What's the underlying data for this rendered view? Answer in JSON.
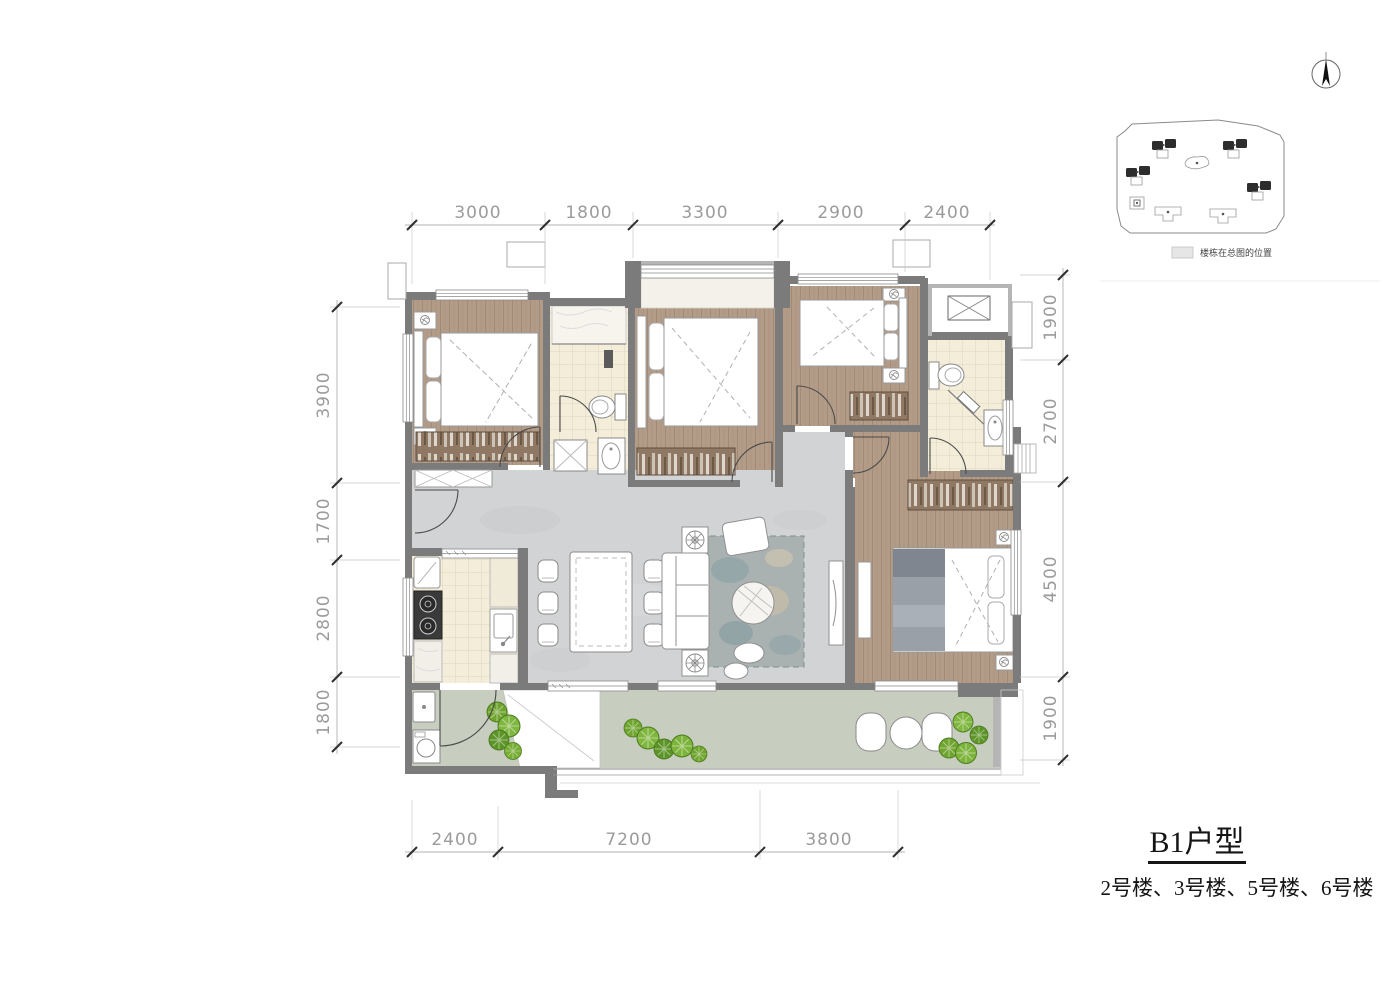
{
  "drawing": {
    "title": "B1户型",
    "subtitle": "2号楼、3号楼、5号楼、6号楼"
  },
  "site_map": {
    "legend_label": "楼栋在总图的位置",
    "highlight_building_count": 4
  },
  "dimensions": {
    "top": [
      "3000",
      "1800",
      "3300",
      "2900",
      "2400"
    ],
    "left": [
      "3900",
      "1700",
      "2800",
      "1800"
    ],
    "right": [
      "1900",
      "2700",
      "4500",
      "1900"
    ],
    "bottom": [
      "2400",
      "7200",
      "3800"
    ]
  },
  "icons": [
    "north-arrow-icon",
    "ac-unit-icon",
    "toilet-icon",
    "shower-icon",
    "sink-icon",
    "stove-icon",
    "fridge-icon",
    "washer-icon",
    "tree-icon",
    "sofa-icon",
    "bed-icon",
    "dining-table-icon"
  ],
  "colors": {
    "wall": "#7b7b7b",
    "wall_light": "#b5b5b5",
    "wood_floor": "#b29b87",
    "living_floor": "#d1d3d4",
    "tile_floor": "#f3edda",
    "balcony_floor": "#c7cdbf",
    "rug": "#a9b2b1",
    "plant_green": "#7cb33a",
    "dim_text": "#9b9b9b",
    "title_text": "#151515"
  }
}
